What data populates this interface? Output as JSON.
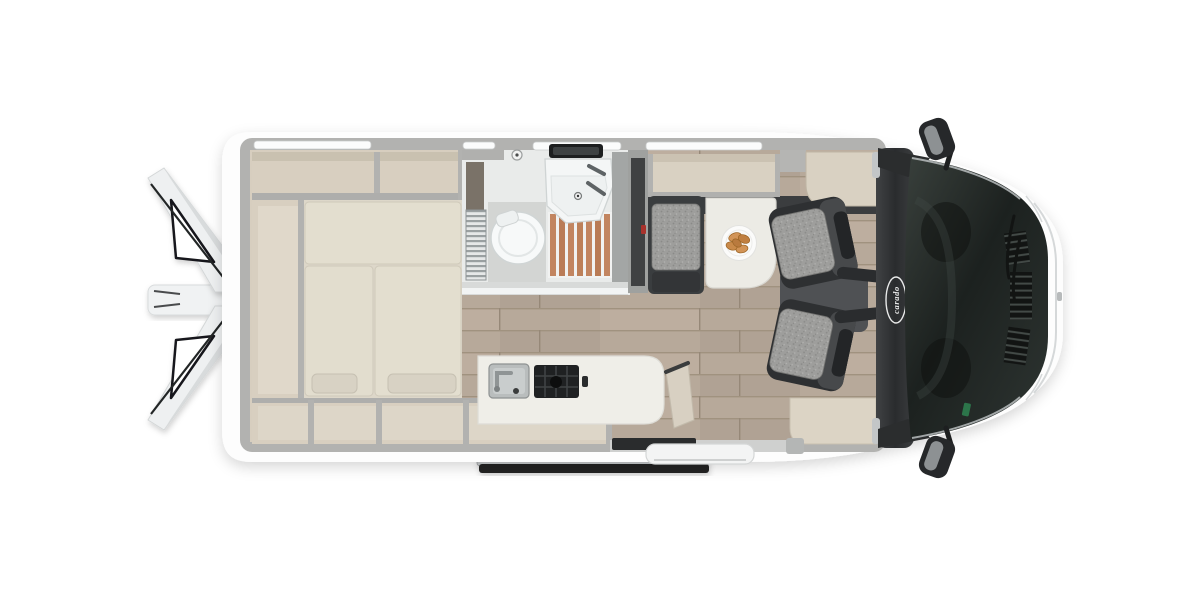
{
  "image": {
    "type": "camper-van-floorplan-top-view",
    "description": "Top-down cutaway floor plan rendering of a Carado camper van with rear doors open"
  },
  "branding": {
    "badge_text": "carado"
  },
  "colors": {
    "background": "#ffffff",
    "body_white": "#fdfdfd",
    "wall_grey": "#b2b2b0",
    "furniture_beige": "#d7cebf",
    "cushion_beige": "#e3decf",
    "floor_wood": "#b7a99a",
    "shower_wood": "#c28560",
    "seat_fabric_grey": "#9e9e9c",
    "charcoal": "#2c2e30",
    "table_white": "#ecebe5",
    "pastry_orange": "#cf8f52",
    "sticker_green": "#2e7d4f",
    "seatbelt_red": "#a8322c"
  },
  "floorplan": {
    "features": [
      "rear-doors-open",
      "rear-storage-shelves",
      "transverse-double-bed",
      "bathroom-with-toilet-sink-shower",
      "wardrobe",
      "dinette-bench",
      "dining-table-with-plate",
      "kitchen-with-sink-and-hob",
      "entry-step-and-sliding-door",
      "swivel-cab-seats",
      "dashboard",
      "windshield",
      "side-mirrors"
    ]
  }
}
